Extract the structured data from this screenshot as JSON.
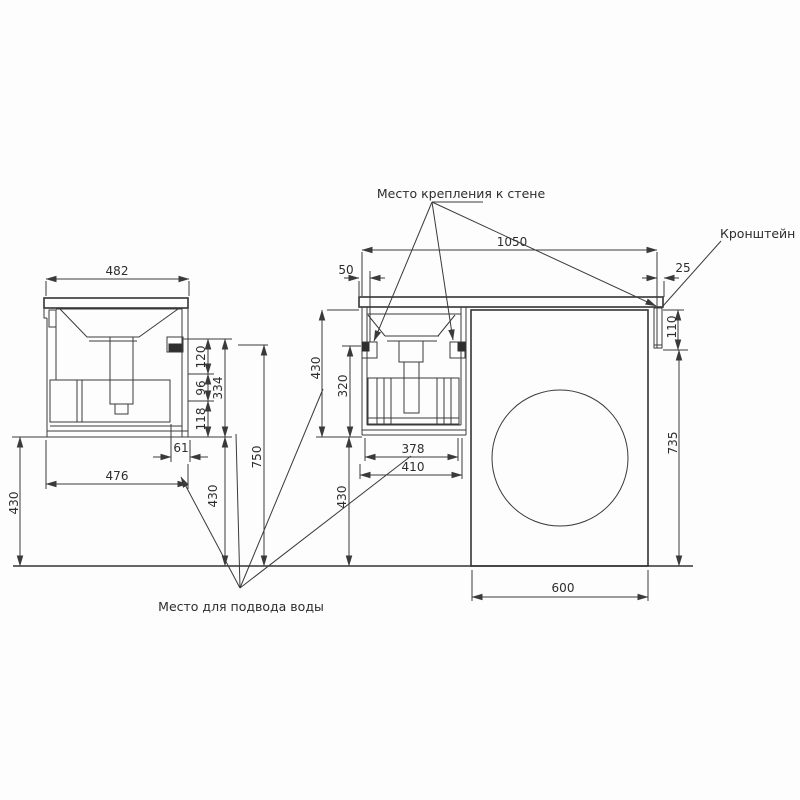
{
  "labels": {
    "wall_mount": "Место крепления к стене",
    "bracket": "Кронштейн",
    "water_supply": "Место для подвода воды"
  },
  "side_view": {
    "top_width": "482",
    "body_width": "476",
    "drain_offset": "61",
    "seg_top": "120",
    "seg_mid": "96",
    "seg_bottom": "118",
    "seg_total": "334",
    "mount_height": "750",
    "clearance_left": "430",
    "clearance_mid": "430"
  },
  "front_view": {
    "total_width": "1050",
    "left_offset": "50",
    "right_offset": "25",
    "cabinet_height": "430",
    "bracket_to_bottom": "320",
    "floor_clearance": "430",
    "drain_width": "378",
    "cabinet_width": "410",
    "machine_width": "600",
    "bracket_height": "110",
    "machine_height": "735"
  },
  "colors": {
    "line": "#3a3a3a",
    "text": "#2d2d2d",
    "background": "#ffffff"
  }
}
